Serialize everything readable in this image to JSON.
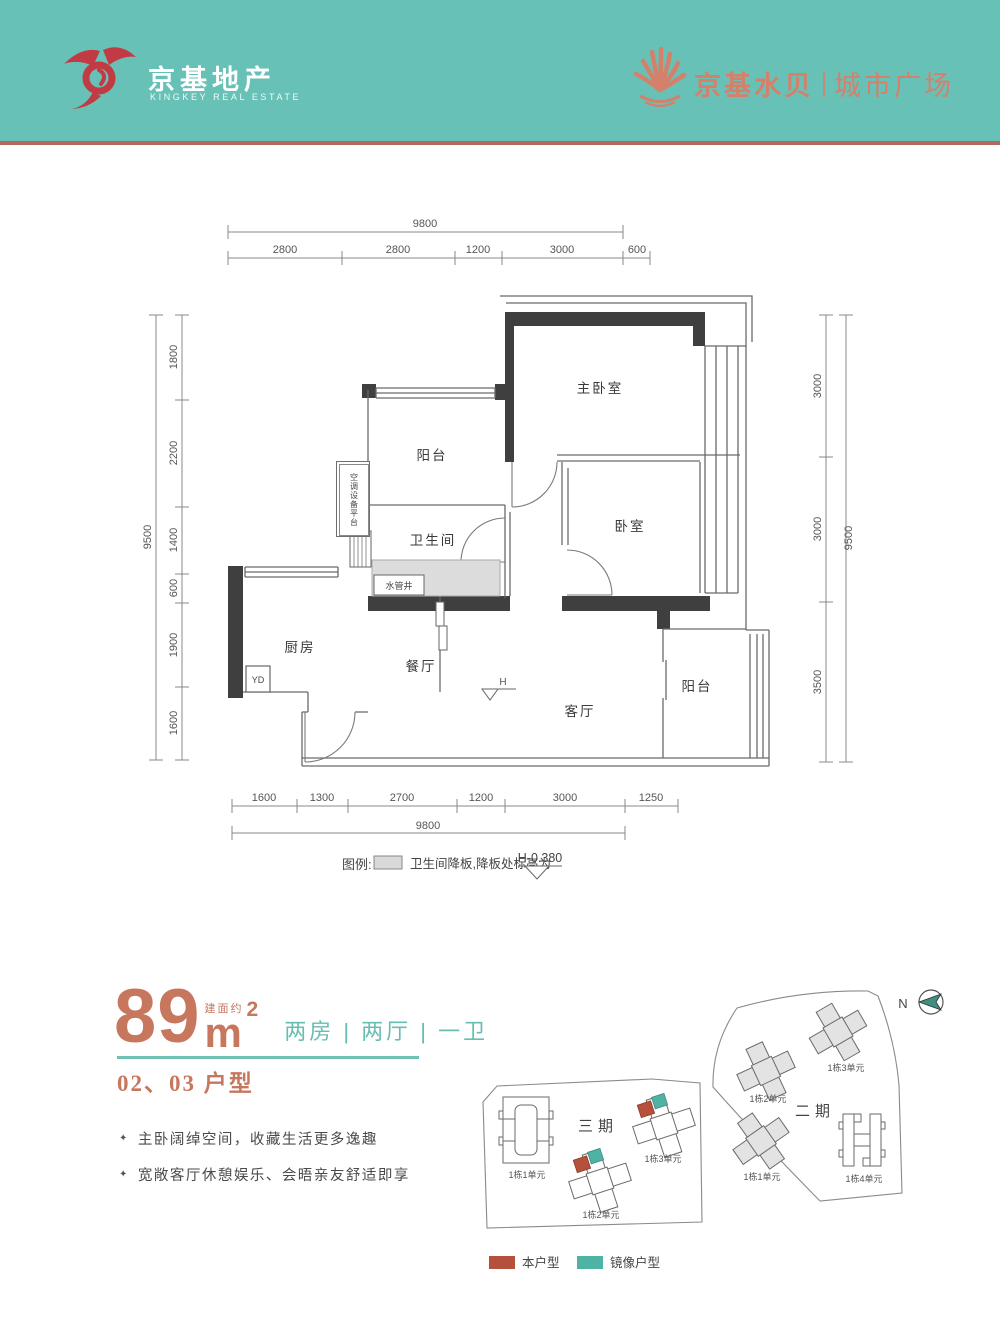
{
  "header": {
    "brand_cn": "京基地产",
    "brand_en": "KINGKEY REAL ESTATE",
    "project_name": "京基水贝",
    "project_sub": "城市广场"
  },
  "colors": {
    "header_band": "#68c1b6",
    "header_rule": "#b2695c",
    "brand_red": "#c23b44",
    "brand_coral": "#d5806a",
    "accent_teal": "#68bdb2",
    "unit_self": "#b5503d",
    "unit_mirror": "#4fb3a4"
  },
  "floorplan": {
    "rooms": {
      "master": "主卧室",
      "bedroom": "卧室",
      "balcony_top": "阳台",
      "bath": "卫生间",
      "kitchen": "厨房",
      "dining": "餐厅",
      "living": "客厅",
      "balcony_right": "阳台"
    },
    "notes": {
      "pipe_shaft": "水管井",
      "ac_platform": "空调设备平台",
      "yd": "YD",
      "elevation": "H"
    },
    "dims": {
      "top_total": "9800",
      "top": [
        "2800",
        "2800",
        "1200",
        "3000",
        "600"
      ],
      "bottom": [
        "1600",
        "1300",
        "2700",
        "1200",
        "3000",
        "1250"
      ],
      "bottom_total": "9800",
      "left_total": "9500",
      "left": [
        "1800",
        "2200",
        "1400",
        "600",
        "1900",
        "1600"
      ],
      "right": [
        "3000",
        "3000",
        "3500"
      ],
      "right_total": "9500"
    },
    "legend": {
      "title": "图例:",
      "desc": "卫生间降板,降板处标高为",
      "value": "H-0.380"
    }
  },
  "info": {
    "area_prefix": "建面约",
    "area": "89",
    "area_unit": "m",
    "area_sup": "2",
    "layout": "两房 | 两厅 | 一卫",
    "unit_code": "02、03 户型",
    "bullet": "✦",
    "features": [
      "主卧阔绰空间，收藏生活更多逸趣",
      "宽敞客厅休憩娱乐、会晤亲友舒适即享"
    ]
  },
  "siteplan": {
    "compass": "N",
    "phase3": {
      "name": "三期",
      "b1": "1栋1单元",
      "b2": "1栋2单元",
      "b3": "1栋3单元"
    },
    "phase2": {
      "name": "二期",
      "b1": "1栋1单元",
      "b2": "1栋2单元",
      "b3": "1栋3单元",
      "b4": "1栋4单元"
    },
    "legend_self": "本户型",
    "legend_mirror": "镜像户型"
  }
}
